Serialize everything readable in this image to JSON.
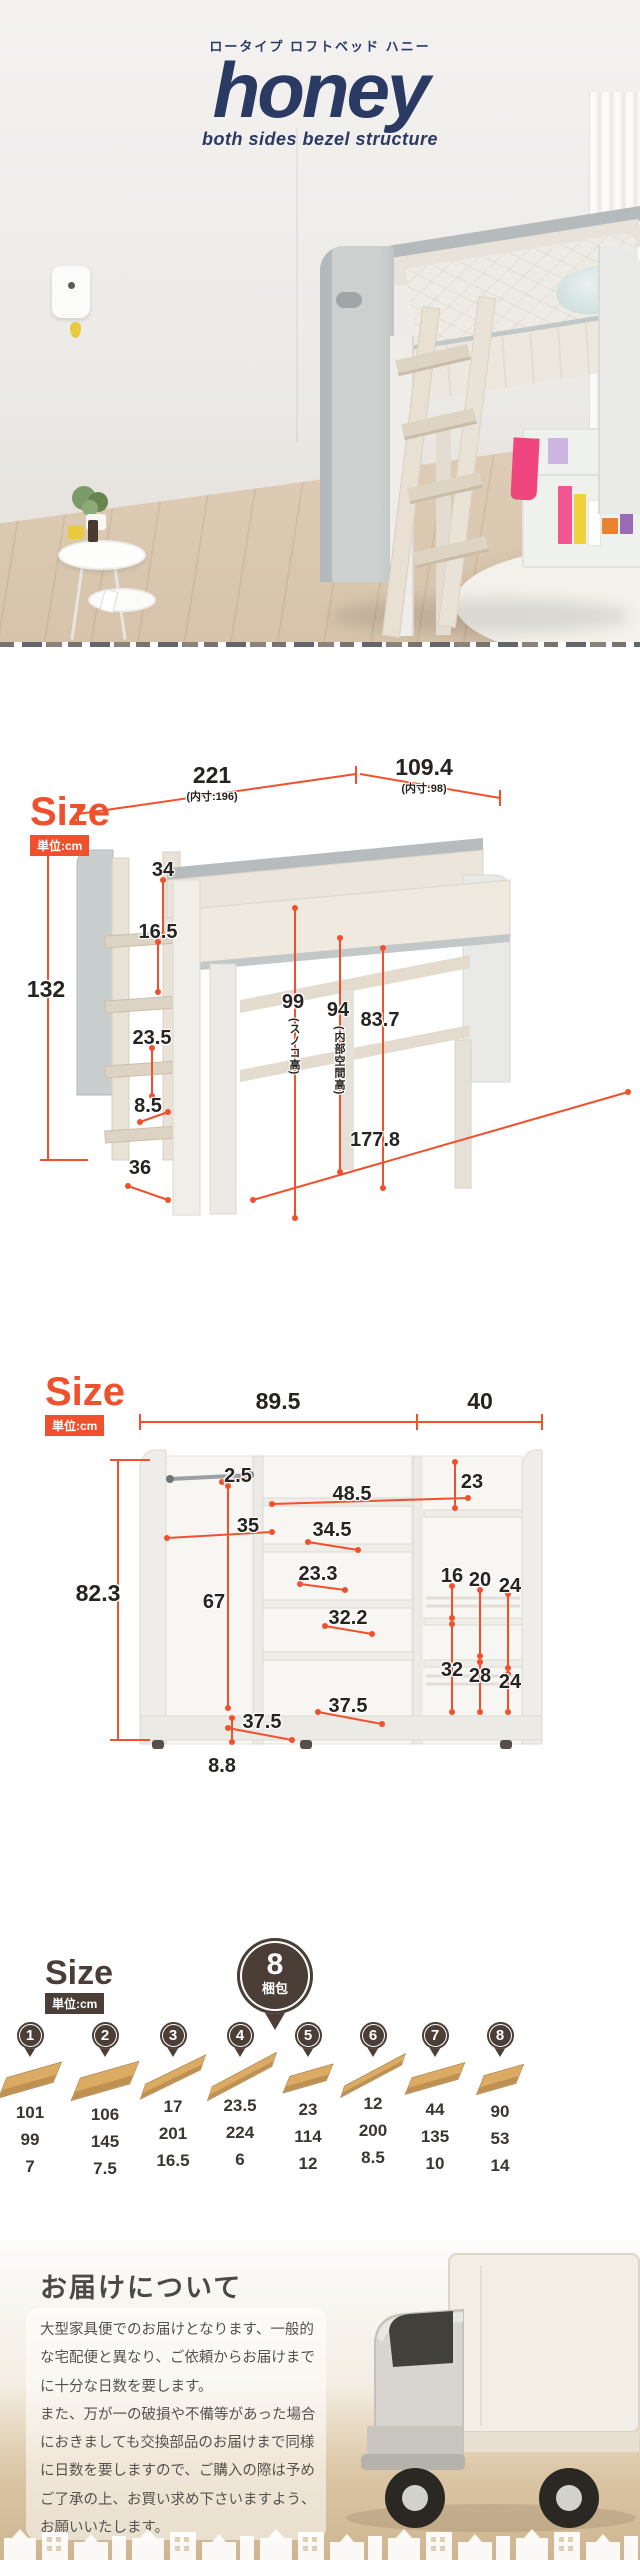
{
  "hero": {
    "subtitle": "ロータイプ ロフトベッド ハニー",
    "title": "honey",
    "tagline": "both sides bezel structure"
  },
  "sizeBed": {
    "heading": "Size",
    "unit": "単位:cm",
    "d221": "221",
    "inner196": "(内寸:196)",
    "d1094": "109.4",
    "inner98": "(内寸:98)",
    "d34": "34",
    "d165": "16.5",
    "d132": "132",
    "d235": "23.5",
    "d99": "99",
    "note99": "(スノコ高)",
    "d94": "94",
    "note94": "(内部空間高)",
    "d837": "83.7",
    "d85": "8.5",
    "d36": "36",
    "d1778": "177.8"
  },
  "sizeWagon": {
    "heading": "Size",
    "unit": "単位:cm",
    "d895": "89.5",
    "d40": "40",
    "d25": "2.5",
    "d23": "23",
    "d485": "48.5",
    "d35": "35",
    "d345": "34.5",
    "d233": "23.3",
    "d16": "16",
    "d20": "20",
    "d24": "24",
    "d823": "82.3",
    "d67": "67",
    "d322": "32.2",
    "d32": "32",
    "d28": "28",
    "d24b": "24",
    "d375a": "37.5",
    "d375b": "37.5",
    "d88": "8.8"
  },
  "packages": {
    "heading": "Size",
    "unit": "単位:cm",
    "badge_count": "8",
    "badge_label": "梱包",
    "items": [
      {
        "n": "1",
        "d": [
          "101",
          "99",
          "7"
        ]
      },
      {
        "n": "2",
        "d": [
          "106",
          "145",
          "7.5"
        ]
      },
      {
        "n": "3",
        "d": [
          "17",
          "201",
          "16.5"
        ]
      },
      {
        "n": "4",
        "d": [
          "23.5",
          "224",
          "6"
        ]
      },
      {
        "n": "5",
        "d": [
          "23",
          "114",
          "12"
        ]
      },
      {
        "n": "6",
        "d": [
          "12",
          "200",
          "8.5"
        ]
      },
      {
        "n": "7",
        "d": [
          "44",
          "135",
          "10"
        ]
      },
      {
        "n": "8",
        "d": [
          "90",
          "53",
          "14"
        ]
      }
    ]
  },
  "delivery": {
    "heading": "お届けについて",
    "para1": "大型家具便でのお届けとなります、一般的な宅配便と異なり、ご依頼からお届けまでに十分な日数を要します。",
    "para2": "また、万が一の破損や不備等があった場合におきましても交換部品のお届けまで同様に日数を要しますので、ご購入の際は予めご了承の上、お買い求め下さいますよう、お願いいたします。"
  },
  "colors": {
    "accent": "#f1502d",
    "navy": "#2b3a62",
    "brown": "#4a3e36"
  }
}
